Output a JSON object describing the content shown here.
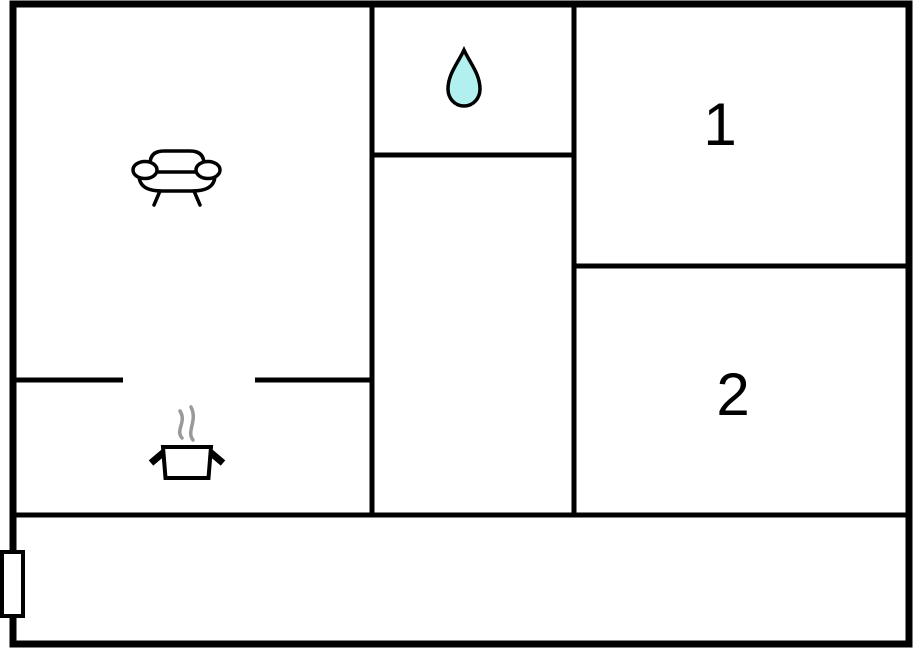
{
  "title": "apartment-floor-plan",
  "colors": {
    "wall": "#000000",
    "background": "#ffffff",
    "drop_fill": "#b2f0f0",
    "drop_stroke": "#000000",
    "steam": "#999999",
    "label_text": "#000000"
  },
  "rooms": {
    "living_room": {
      "name": "living-room",
      "icon": "sofa-icon",
      "label": ""
    },
    "bathroom": {
      "name": "bathroom",
      "icon": "water-drop-icon",
      "label": ""
    },
    "kitchen": {
      "name": "kitchen",
      "icon": "cooking-pot-icon",
      "label": ""
    },
    "bedroom_1": {
      "name": "bedroom-1",
      "label": "1"
    },
    "bedroom_2": {
      "name": "bedroom-2",
      "label": "2"
    },
    "hallway": {
      "name": "hallway",
      "label": ""
    }
  },
  "markers": {
    "window": {
      "icon": "window-door-marker"
    }
  }
}
